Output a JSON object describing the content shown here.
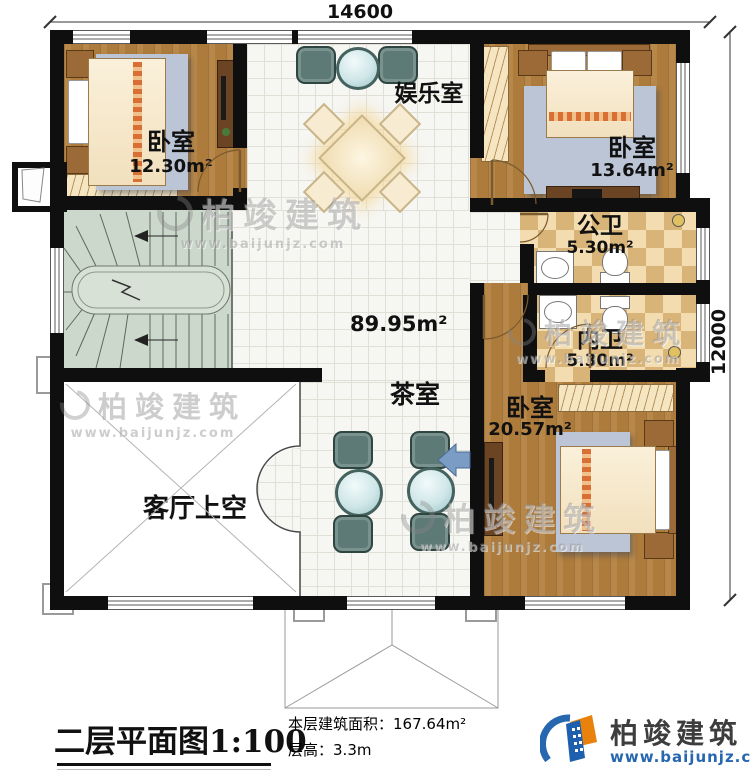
{
  "dimensions": {
    "width": "14600",
    "height": "12000"
  },
  "rooms": {
    "bedroom1": {
      "label": "卧室",
      "area": "12.30m²"
    },
    "entertainment": {
      "label": "娱乐室"
    },
    "bedroom2": {
      "label": "卧室",
      "area": "13.64m²"
    },
    "public_bath": {
      "label": "公卫",
      "area": "5.30m²"
    },
    "private_bath": {
      "label": "内卫",
      "area": "5.30m²"
    },
    "bedroom3": {
      "label": "卧室",
      "area": "20.57m²"
    },
    "tea_room": {
      "label": "茶室"
    },
    "hall": {
      "area": "89.95m²"
    },
    "void": {
      "label": "客厅上空"
    }
  },
  "footer": {
    "plan_title": "二层平面图",
    "plan_scale": "1:100",
    "area_label": "本层建筑面积：",
    "area_value": "167.64m²",
    "floor_height_label": "层高：",
    "floor_height_value": "3.3m"
  },
  "brand": {
    "name": "柏竣建筑",
    "site": "www.baijunjz.com"
  },
  "watermark": {
    "name": "柏竣建筑",
    "site": "www.baijunjz.com"
  },
  "colors": {
    "wall": "#0f0f0f",
    "wood": "#ad7b3c",
    "tile": "#f6f6f3",
    "bath_tile": "#e9cb92",
    "stair": "#cdd8cc",
    "brand_blue": "#2767b0",
    "brand_orange": "#e8820c"
  }
}
